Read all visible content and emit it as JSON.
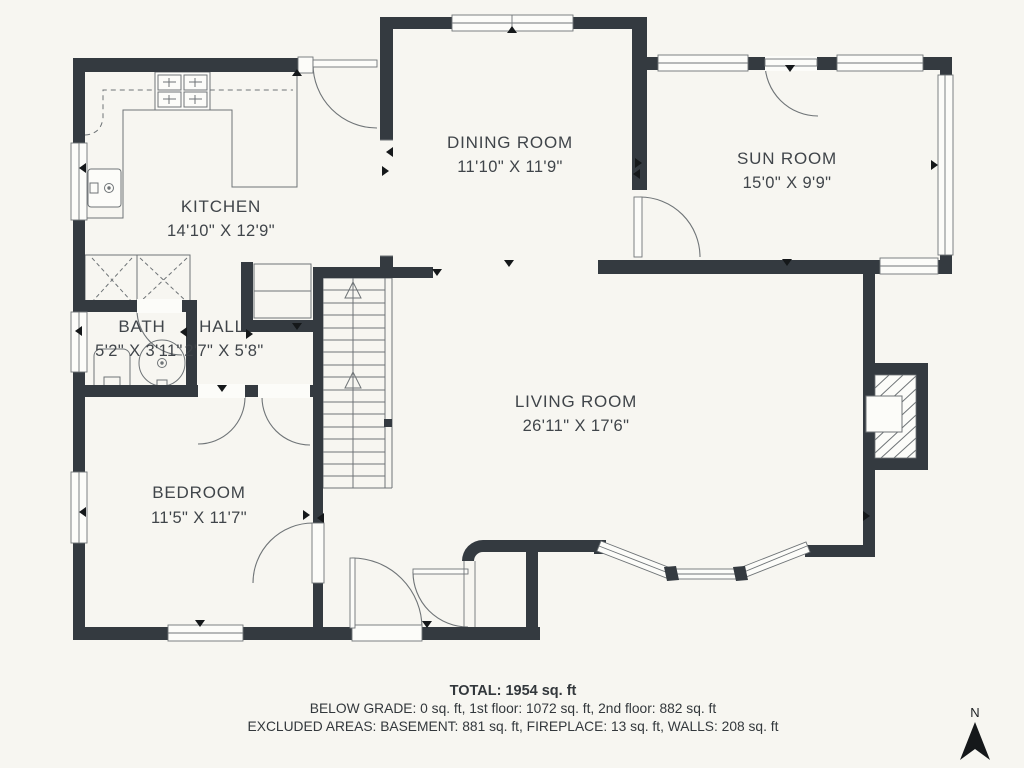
{
  "plan_title": "First floor plan",
  "rooms": [
    {
      "name": "KITCHEN",
      "dims": "14'10\" X 12'9\""
    },
    {
      "name": "DINING ROOM",
      "dims": "11'10\" X 11'9\""
    },
    {
      "name": "SUN ROOM",
      "dims": "15'0\" X 9'9\""
    },
    {
      "name": "BATH",
      "dims": "5'2\" X 3'11\""
    },
    {
      "name": "HALL",
      "dims": "2'7\" X 5'8\""
    },
    {
      "name": "LIVING ROOM",
      "dims": "26'11\" X 17'6\""
    },
    {
      "name": "BEDROOM",
      "dims": "11'5\" X 11'7\""
    }
  ],
  "summary": {
    "total": "TOTAL: 1954 sq. ft",
    "floors": "BELOW GRADE: 0 sq. ft, 1st floor: 1072 sq. ft, 2nd floor: 882 sq. ft",
    "excluded": "EXCLUDED AREAS: BASEMENT: 881 sq. ft, FIREPLACE: 13 sq. ft, WALLS: 208 sq. ft"
  },
  "compass": {
    "label": "N"
  },
  "colors": {
    "background": "#f7f6f1",
    "wall": "#343a40",
    "thin_line": "#6f7477",
    "text": "#40454a",
    "marker": "#15181a",
    "window_fill": "#fcfcf9"
  }
}
